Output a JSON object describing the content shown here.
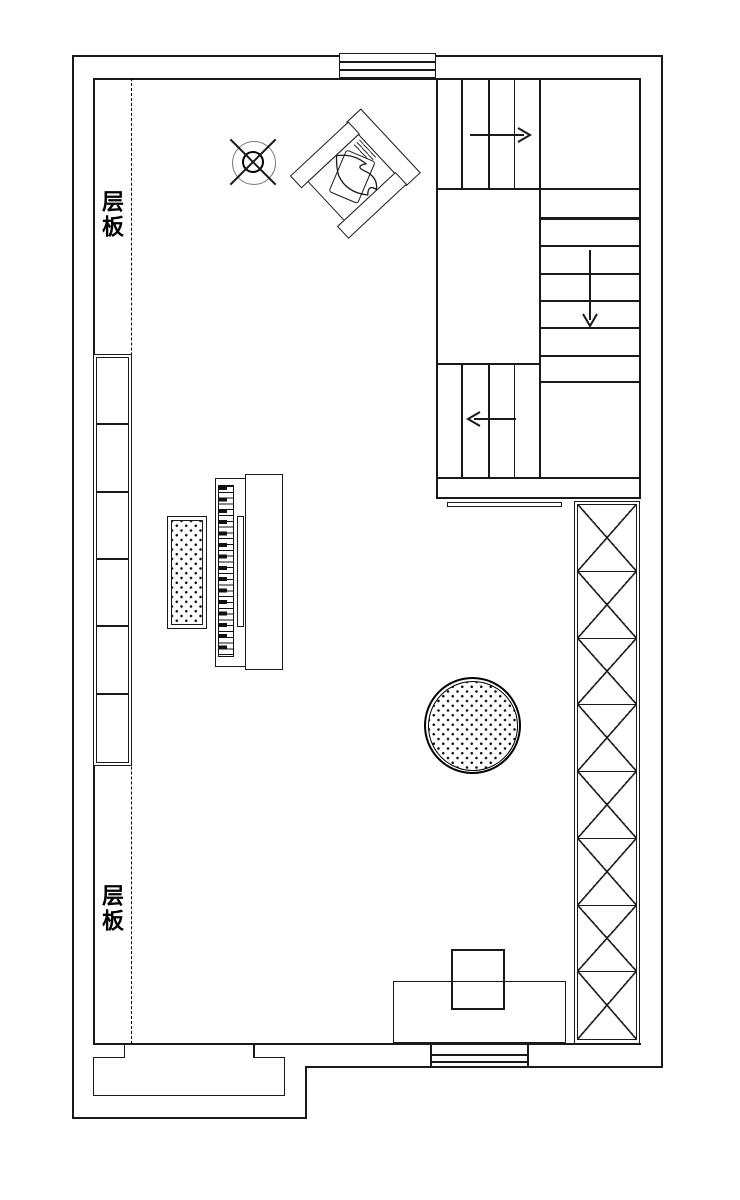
{
  "title": "loft floor plan",
  "labels": {
    "shelf_top": "层板",
    "shelf_bottom": "层板"
  },
  "colors": {
    "line": "#1a1a1a",
    "background": "#ffffff",
    "fan_ring": "#777777"
  },
  "stairs": {
    "upper_flight_arrow": "right",
    "mid_flight_arrow": "down",
    "lower_flight_arrow": "left",
    "upper_treads": 4,
    "mid_treads": 7,
    "lower_treads": 4
  },
  "elements": [
    {
      "name": "ceiling-lamp-symbol",
      "type": "circle-cross"
    },
    {
      "name": "armchair",
      "type": "rotated-armchair-with-pillow"
    },
    {
      "name": "upright-piano",
      "type": "piano-with-keys"
    },
    {
      "name": "piano-bench",
      "type": "dotted-rectangle"
    },
    {
      "name": "round-rug",
      "type": "dotted-circle"
    },
    {
      "name": "shelf-column",
      "cells": 6
    },
    {
      "name": "lattice-railing",
      "cells": 8
    },
    {
      "name": "shelf-dashed-line",
      "type": "dashed"
    },
    {
      "name": "top-window",
      "type": "double-line-window"
    },
    {
      "name": "bottom-window",
      "type": "double-line-window"
    },
    {
      "name": "bottom-cabinet",
      "type": "rectangle"
    },
    {
      "name": "bottom-bay",
      "type": "recessed-bay"
    }
  ]
}
